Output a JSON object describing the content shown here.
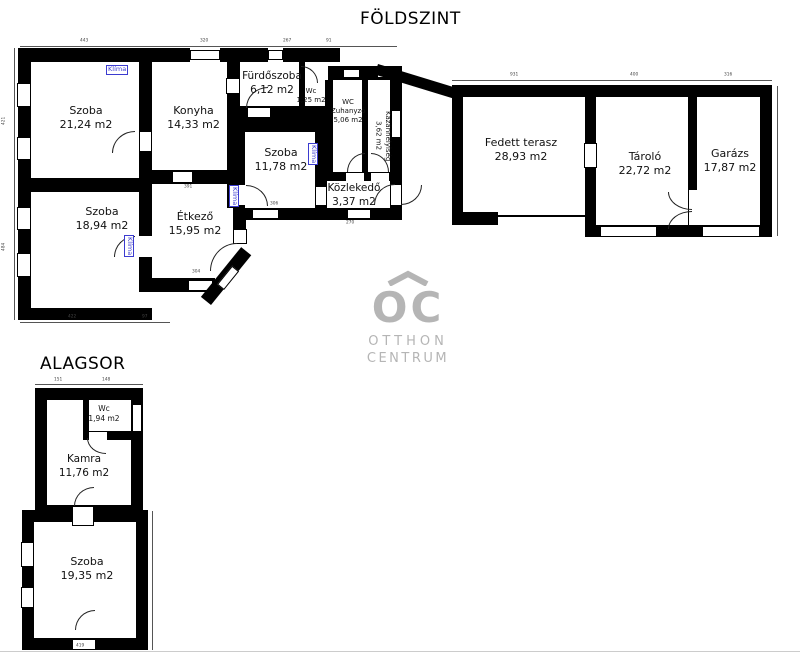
{
  "titles": {
    "ground": "FÖLDSZINT",
    "basement": "ALAGSOR"
  },
  "labels": {
    "klima": "Klíma"
  },
  "logo": {
    "mark": "OC",
    "line1": "OTTHON",
    "line2": "CENTRUM"
  },
  "rooms": {
    "szoba2124": {
      "name": "Szoba",
      "area": "21,24 m2"
    },
    "konyha": {
      "name": "Konyha",
      "area": "14,33 m2"
    },
    "furdoszoba": {
      "name": "Fürdőszoba",
      "area": "6,12 m2"
    },
    "wc125": {
      "name": "Wc",
      "area": "1,25 m2"
    },
    "wczuhanyzo": {
      "name": "WC Zuhanyzó",
      "area": "5,06 m2"
    },
    "kazanhelyiseg": {
      "name": "Kazánhelyiség",
      "area": "3,62 m2"
    },
    "szoba1178": {
      "name": "Szoba",
      "area": "11,78 m2"
    },
    "kozlekedo": {
      "name": "Közlekedő",
      "area": "3,37 m2"
    },
    "szoba1894": {
      "name": "Szoba",
      "area": "18,94 m2"
    },
    "etkezo": {
      "name": "Étkező",
      "area": "15,95 m2"
    },
    "fedettterasz": {
      "name": "Fedett terasz",
      "area": "28,93 m2"
    },
    "tarolo": {
      "name": "Tároló",
      "area": "22,72 m2"
    },
    "garazs": {
      "name": "Garázs",
      "area": "17,87 m2"
    },
    "wc194": {
      "name": "Wc",
      "area": "1,94 m2"
    },
    "kamra": {
      "name": "Kamra",
      "area": "11,76 m2"
    },
    "szoba1935": {
      "name": "Szoba",
      "area": "19,35 m2"
    }
  },
  "dims": {
    "d443": "443",
    "d320": "320",
    "d267": "267",
    "d91": "91",
    "d931": "931",
    "d400": "400",
    "d316": "316",
    "d422": "422",
    "d97": "97",
    "d421": "421",
    "d484": "484",
    "d391": "391",
    "d306": "306",
    "d270": "270",
    "d304": "304",
    "d151": "151",
    "d148": "148",
    "d419": "419"
  },
  "colors": {
    "wall": "#000000",
    "klima_blue": "#3b3bd0",
    "logo_gray": "#b5b5b5"
  }
}
